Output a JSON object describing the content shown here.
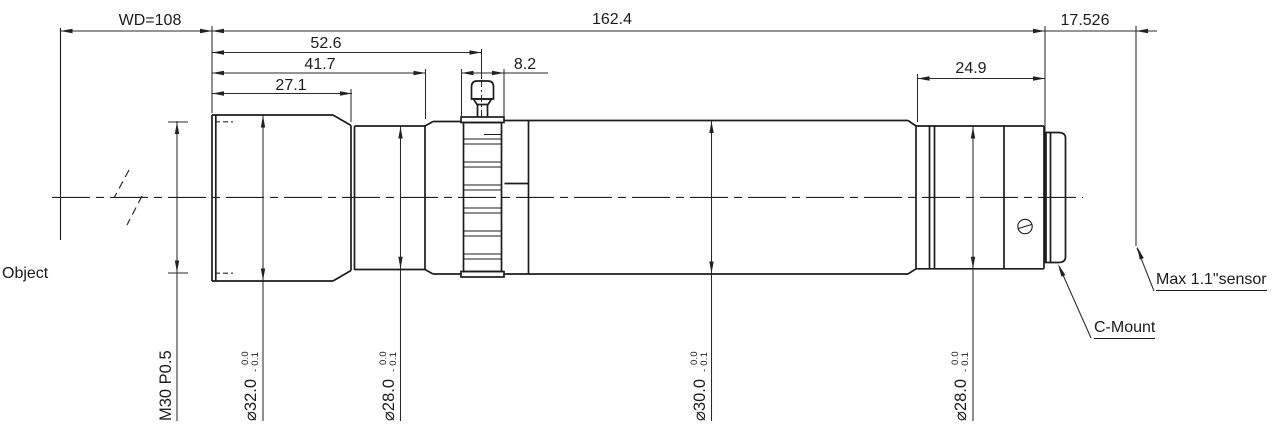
{
  "drawing": {
    "dims": {
      "working_distance": "WD=108",
      "overall_length": "162.4",
      "flange_distance": "17.526",
      "front_to_lock_knob": "52.6",
      "front_to_step": "41.7",
      "front_barrel_length": "27.1",
      "lock_ring_width": "8.2",
      "rear_section_length": "24.9"
    },
    "diams": {
      "front_thread": "M30 P0.5",
      "d32": {
        "v": "⌀32.0",
        "t1": "0.0",
        "t2": "- 0.1"
      },
      "d28a": {
        "v": "⌀28.0",
        "t1": "0.0",
        "t2": "- 0.1"
      },
      "d30": {
        "v": "⌀30.0",
        "t1": "0.0",
        "t2": "- 0.1"
      },
      "d28b": {
        "v": "⌀28.0",
        "t1": "0.0",
        "t2": "- 0.1"
      }
    },
    "labels": {
      "object": "Object",
      "c_mount": "C-Mount",
      "sensor": "Max 1.1\"sensor"
    }
  }
}
